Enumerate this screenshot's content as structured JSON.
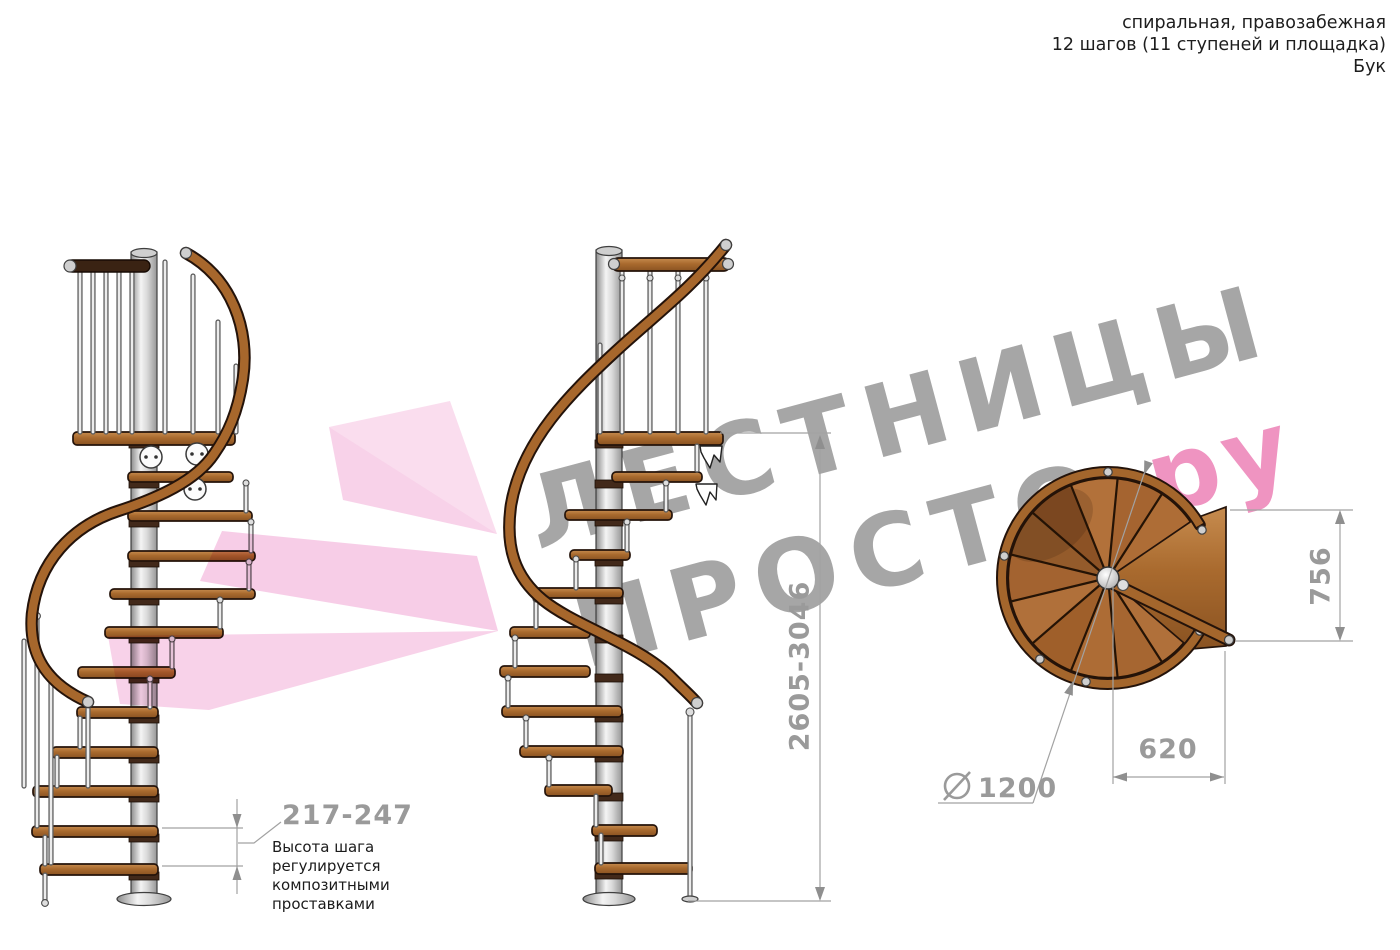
{
  "header": {
    "type_line": "спиральная, правозабежная",
    "steps_line": "12 шагов (11 ступеней и площадка)",
    "material_line": "Бук"
  },
  "watermark": {
    "word1": "ЛЕСТНИЦЫ",
    "word2": "ПРОСТО",
    "dot": ".",
    "suffix": "ру"
  },
  "dimensions": {
    "total_height": {
      "value": "2605-3046"
    },
    "step_height": {
      "value": "217-247",
      "note": "Высота шага регулируется композитными проставками"
    },
    "plan_depth": {
      "value": "756"
    },
    "plan_width": {
      "value": "620"
    },
    "diameter": {
      "symbol": "⌀",
      "value": "1200"
    }
  },
  "colors": {
    "wood": "#a96a2e",
    "wood_light": "#c78c4f",
    "wood_dark": "#8a5322",
    "outline": "#24130a",
    "metal_light": "#f4f4f4",
    "metal_dark": "#8c8c8c",
    "dimension_gray": "#9a9a9a",
    "watermark_gray": "#a6a6a6",
    "watermark_pink": "#ef94c1",
    "watermark_dot_pink": "#d9477c",
    "arrow_pink": "#f3b0d8",
    "text_black": "#1d1d1d"
  }
}
